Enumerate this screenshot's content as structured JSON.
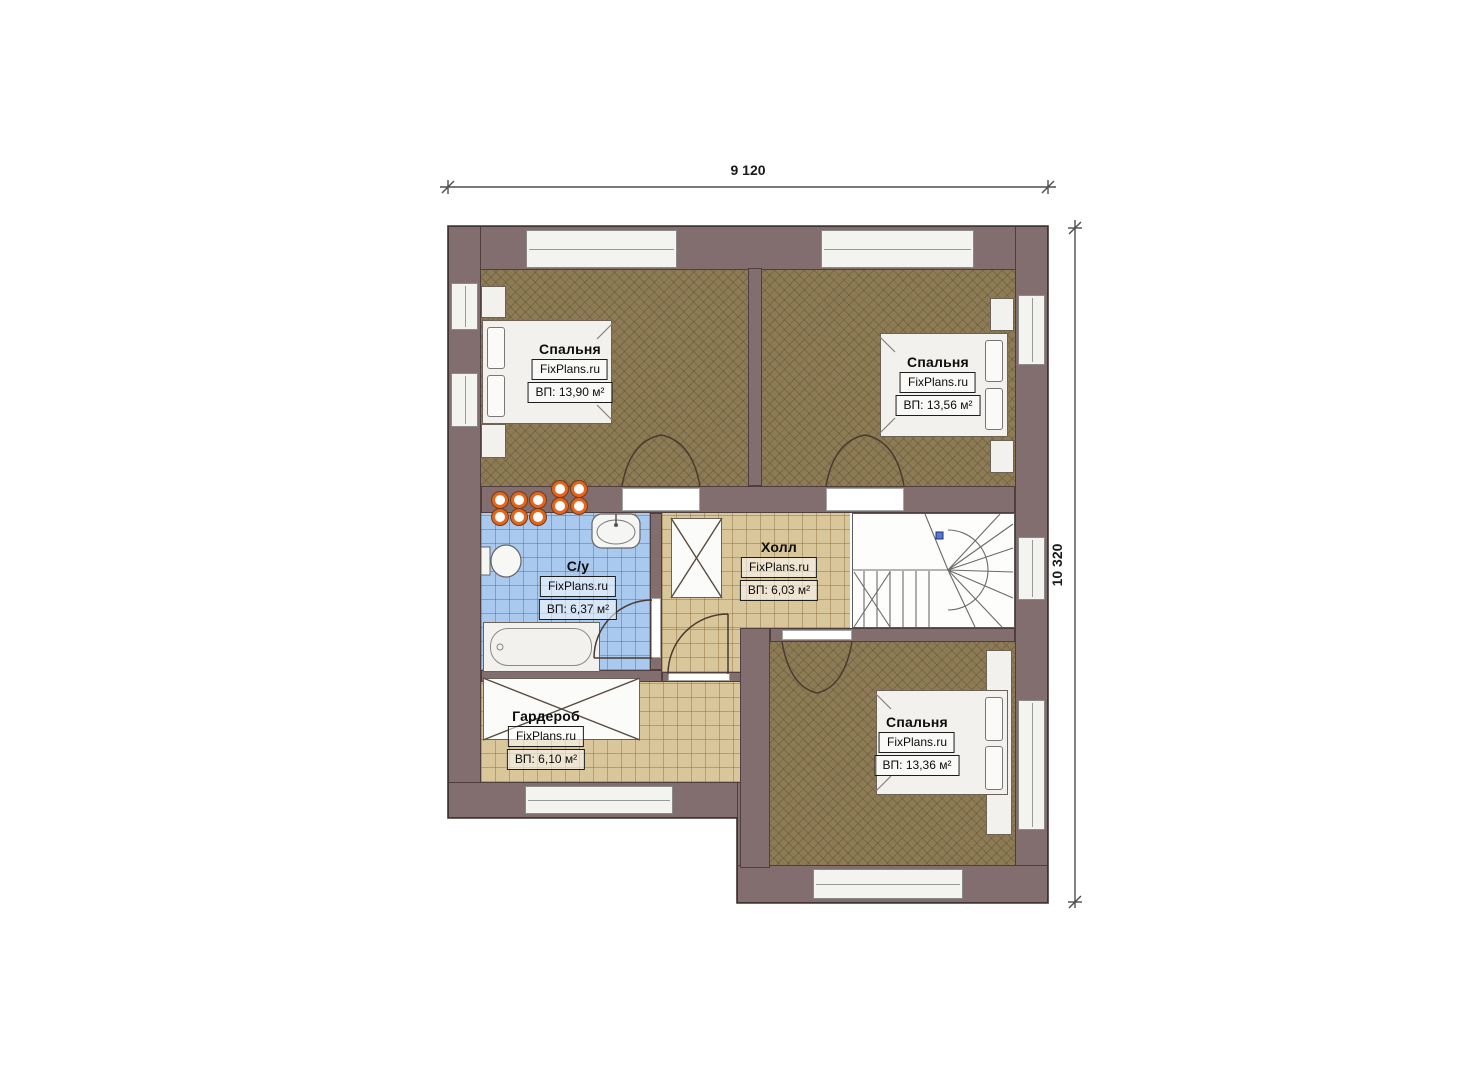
{
  "dimensions": {
    "width_label": "9 120",
    "height_label": "10 320"
  },
  "rooms": [
    {
      "name": "Спальня",
      "brand": "FixPlans.ru",
      "area": "ВП: 13,90 м²"
    },
    {
      "name": "Спальня",
      "brand": "FixPlans.ru",
      "area": "ВП: 13,56 м²"
    },
    {
      "name": "С/у",
      "brand": "FixPlans.ru",
      "area": "ВП: 6,37 м²"
    },
    {
      "name": "Холл",
      "brand": "FixPlans.ru",
      "area": "ВП: 6,03 м²"
    },
    {
      "name": "Гардероб",
      "brand": "FixPlans.ru",
      "area": "ВП: 6,10 м²"
    },
    {
      "name": "Спальня",
      "brand": "FixPlans.ru",
      "area": "ВП: 13,36 м²"
    }
  ],
  "colors": {
    "wall": "#826e6e",
    "bedroom_floor": "#8c7b55",
    "tile_floor": "#d9c69b",
    "bath_floor": "#a9c9ee",
    "fixture_accent": "#e2661f"
  }
}
